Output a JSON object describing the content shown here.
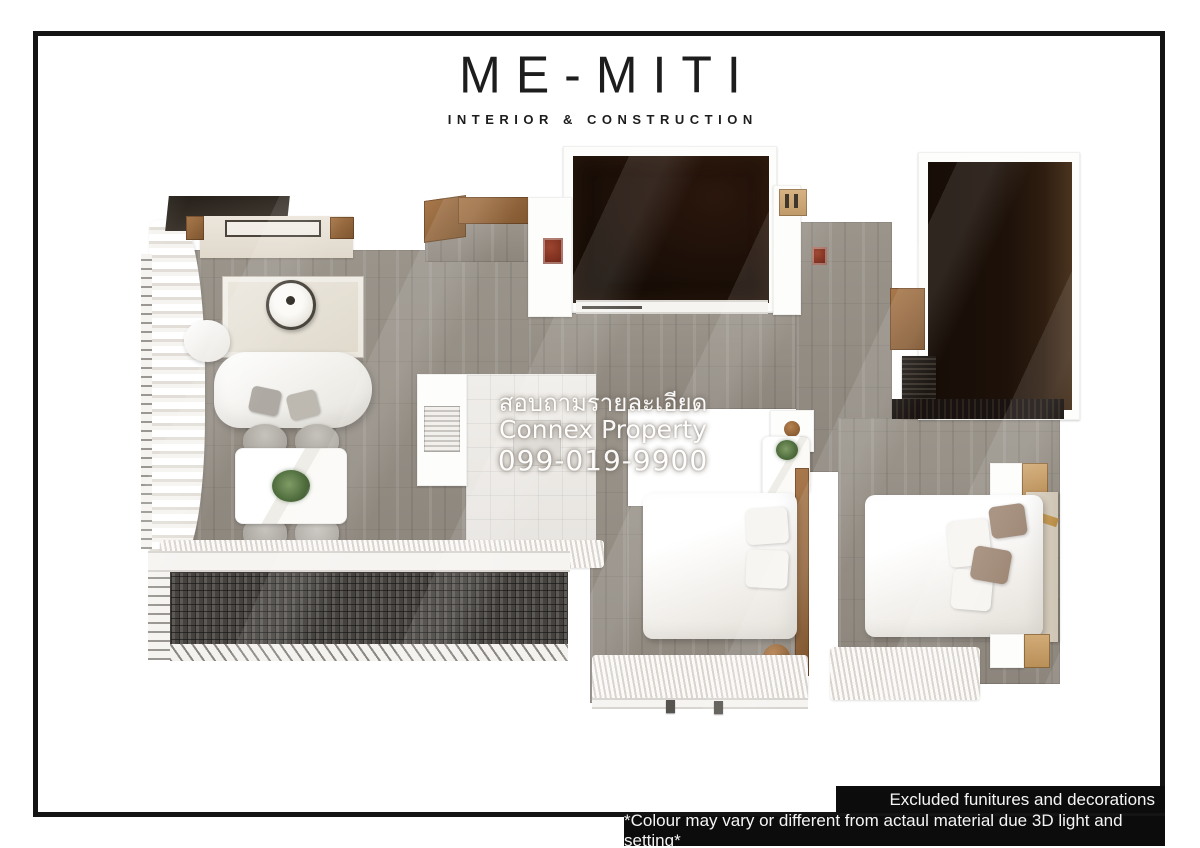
{
  "logo": {
    "title": "ME-MITI",
    "subtitle": "INTERIOR & CONSTRUCTION"
  },
  "watermark": {
    "line1": "สอบถามรายละเอียด",
    "line2": "Connex Property",
    "line3": "099-019-9900"
  },
  "notes": [
    {
      "text": "Excluded funitures and decorations"
    },
    {
      "text": "*Colour may vary or different from actaul material due 3D light and setting*"
    }
  ],
  "colors": {
    "frame": "#141414",
    "logo-ink": "#1d1d1d",
    "wood-a": "#9a948b",
    "wood-b": "#8d867d",
    "dark1-a": "#2a160c",
    "dark1-b": "#150c06",
    "dark2-a": "#170d07",
    "dark2-b": "#4a3420",
    "mesh-a": "#5d5a55",
    "mesh-b": "#454340",
    "accent-a": "#a9794c",
    "accent-b": "#7e552f",
    "cream-a": "#ece6dc",
    "cream-b": "#e0d9cc",
    "chair": "#aeaaa3",
    "taupe": "#a08977",
    "note-bg": "#0c0c0c",
    "note-fg": "#f5f5f5",
    "wm": "#ffffff"
  }
}
